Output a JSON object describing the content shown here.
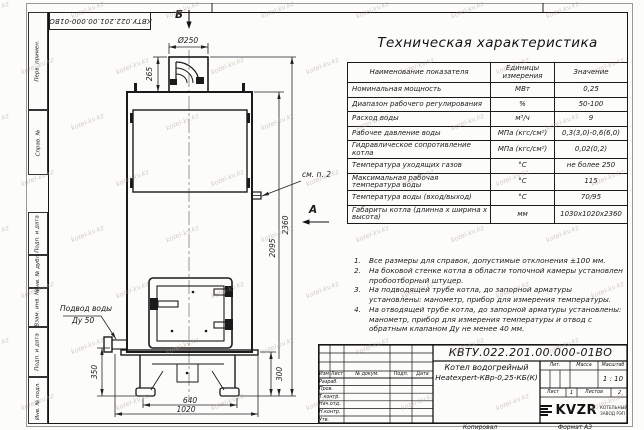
{
  "sheet": {
    "top_stamp": "КВТУ.022.201.00.000-01ВО",
    "watermark": "kotel-kv.kz",
    "margin_labels": {
      "perv": "Перв. примен.",
      "sprav": "Справ. №",
      "podp1": "Подп. и дата",
      "inv_dubl": "Инв. № дубл.",
      "vzam": "Взам. инв. №",
      "podp2": "Подп. и дата",
      "inv_podl": "Инв. № подл."
    },
    "copy_label": "Копировал",
    "format_label": "Формат А3"
  },
  "drawing": {
    "section_b": "Б",
    "view_a": "А",
    "callout_note2": "см. п. 2",
    "water_inlet": {
      "line1": "Подвод воды",
      "line2": "Ду 50"
    },
    "dims": {
      "chimney_diameter": "Ø250",
      "chimney_height": "265",
      "total_height": "2360",
      "body_height": "2095",
      "inlet_height": "350",
      "base_height": "300",
      "base_width": "640",
      "total_width": "1020"
    }
  },
  "spec_table": {
    "title": "Техническая характеристика",
    "headers": [
      "Наименование показателя",
      "Единицы измерения",
      "Значение"
    ],
    "rows": [
      [
        "Номинальная мощность",
        "МВт",
        "0,25"
      ],
      [
        "Диапазон рабочего регулирования",
        "%",
        "50-100"
      ],
      [
        "Расход воды",
        "м³/ч",
        "9"
      ],
      [
        "Рабочее давление воды",
        "МПа (кгс/см²)",
        "0,3(3,0)-0,6(6,0)"
      ],
      [
        "Гидравлическое сопротивление котла",
        "МПа (кгс/см²)",
        "0,02(0,2)"
      ],
      [
        "Температура уходящих газов",
        "°С",
        "не более 250"
      ],
      [
        "Максимальная рабочая температура воды",
        "°С",
        "115"
      ],
      [
        "Температура воды (вход/выход)",
        "°С",
        "70/95"
      ],
      [
        "Габариты котла (длинна х ширина х высота)",
        "мм",
        "1030х1020х2360"
      ]
    ]
  },
  "notes": [
    {
      "num": "1.",
      "text": "Все размеры для справок, допустимые отклонения ±100 мм."
    },
    {
      "num": "2.",
      "text": "На боковой стенке котла в области топочной камеры установлен пробоотборный штуцер."
    },
    {
      "num": "3.",
      "text": "На подводящей трубе котла, до запорной арматуры установлены: манометр, прибор для измерения температуры."
    },
    {
      "num": "4.",
      "text": "На отводящей трубе котла, до запорной арматуры установлены: манометр, прибор для измерения температуры и отвод с обратным клапаном Ду не менее 40 мм."
    }
  ],
  "title_block": {
    "doc_number": "КВТУ.022.201.00.000-01ВО",
    "product_name_line1": "Котел водогрейный",
    "product_name_line2": "Heatexpert-КВр-0,25-КБ(К)",
    "rev_header": {
      "izm": "Изм",
      "list": "Лист",
      "doc": "№ докум.",
      "podp": "Подп.",
      "data": "Дата"
    },
    "row_labels": [
      "Разраб.",
      "Пров.",
      "Т.контр.",
      "Нач.отд.",
      "Н.контр.",
      "Утв."
    ],
    "lit_label": "Лит.",
    "mass_label": "Масса",
    "scale_label": "Масштаб",
    "scale_value": "1 : 10",
    "sheet_label": "Лист",
    "sheet_value": "1",
    "sheets_label": "Листов",
    "sheets_value": "2",
    "logo_text": "KVZR",
    "logo_sub1": "КОТЕЛЬНЫЙ",
    "logo_sub2": "ЗАВОД РЭП"
  }
}
